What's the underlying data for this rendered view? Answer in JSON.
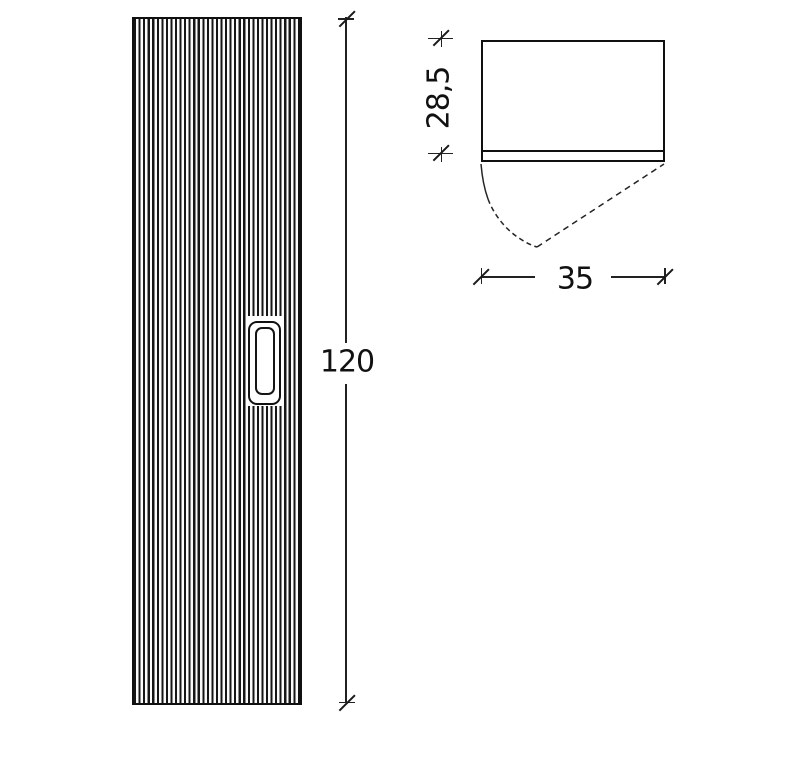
{
  "drawing": {
    "labels": {
      "height": "120",
      "width": "35",
      "depth": "28,5"
    },
    "colors": {
      "background": "#ffffff",
      "line": "#1a1a1a",
      "text": "#111111"
    }
  }
}
